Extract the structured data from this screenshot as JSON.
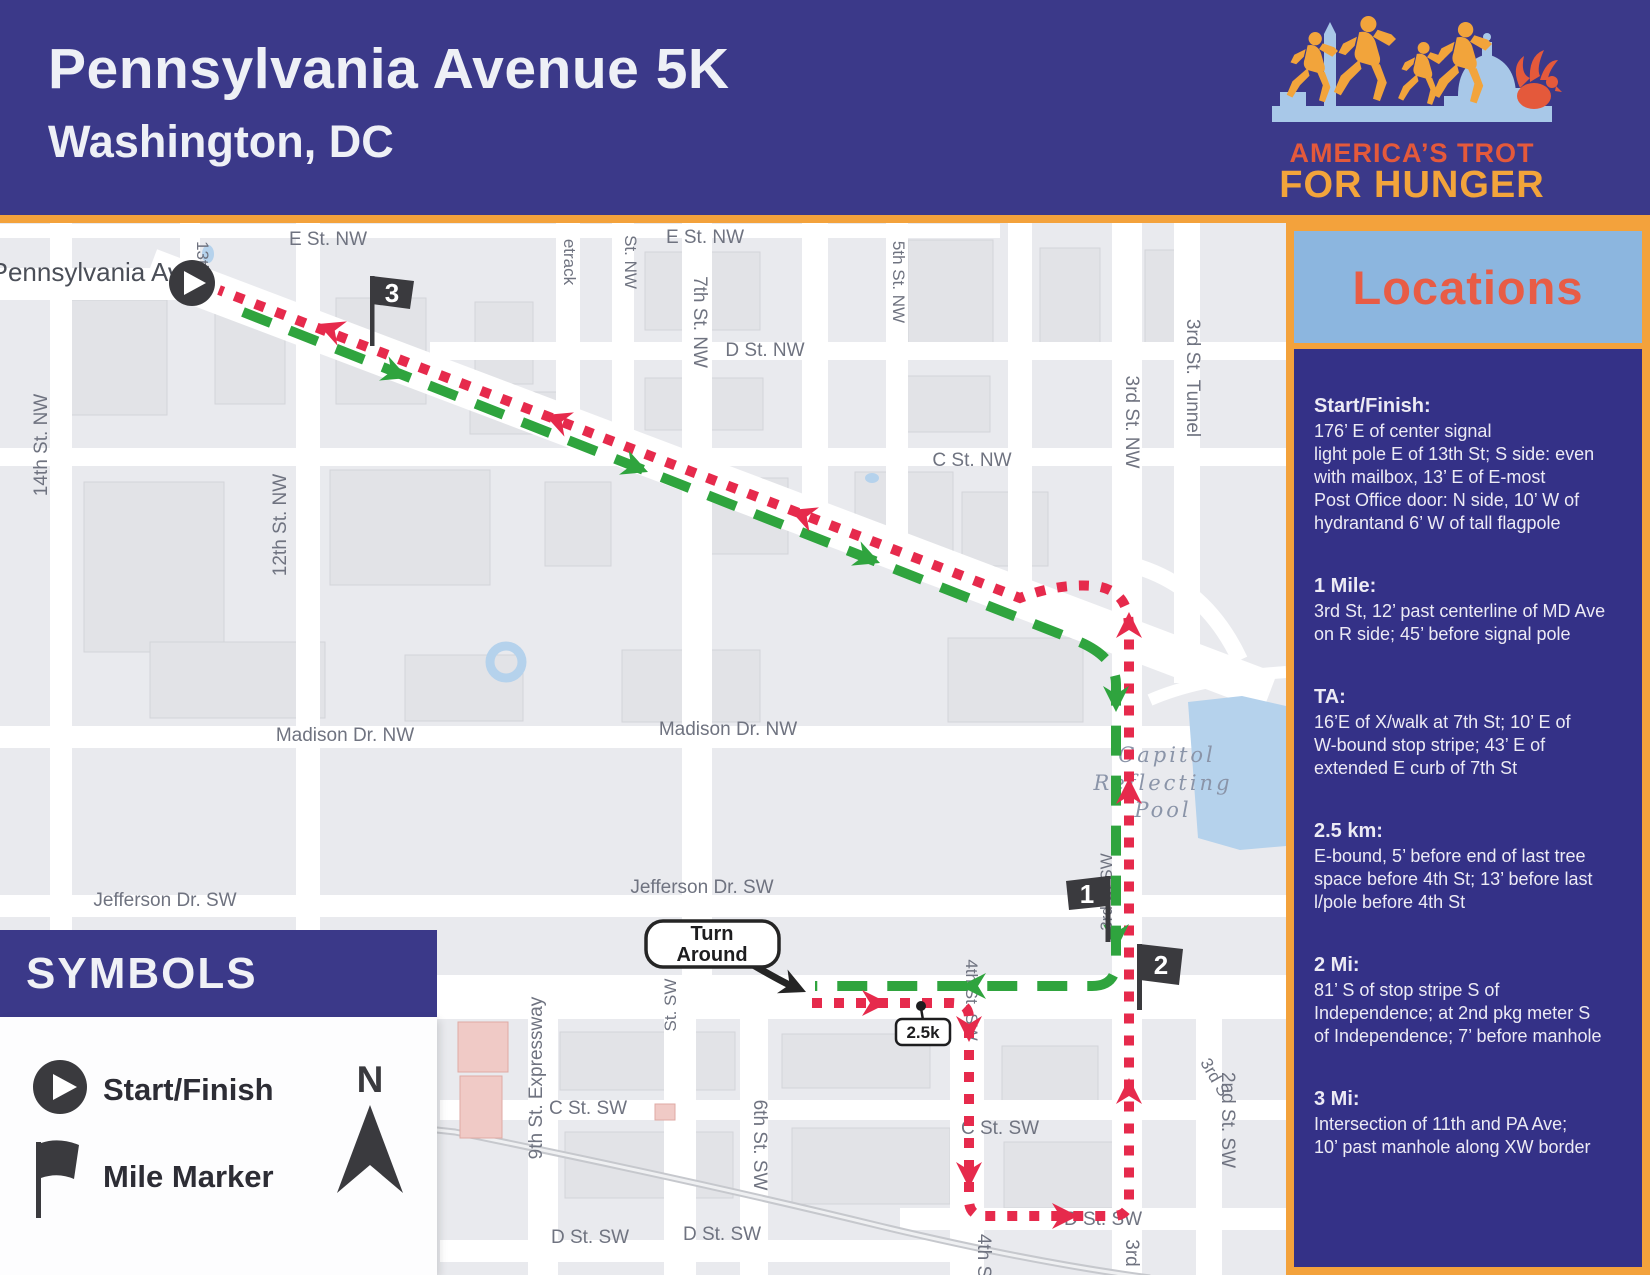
{
  "header": {
    "title": "Pennsylvania Avenue 5K",
    "subtitle": "Washington, DC"
  },
  "logo": {
    "line1": "AMERICA’S TROT",
    "line2": "FOR HUNGER"
  },
  "locations": {
    "title": "Locations",
    "sections": [
      {
        "heading": "Start/Finish:",
        "body": "176’ E of center signal\nlight pole E of 13th St; S side: even\nwith mailbox, 13’ E of E-most\nPost Office door: N side, 10’ W of\nhydrantand 6’ W of tall flagpole"
      },
      {
        "heading": "1 Mile:",
        "body": "3rd St, 12’ past centerline of MD Ave\non R side; 45’ before signal pole"
      },
      {
        "heading": "TA:",
        "body": "16’E of X/walk at 7th St; 10’ E of\nW-bound stop stripe; 43’ E of\nextended E curb of 7th St"
      },
      {
        "heading": "2.5 km:",
        "body": "E-bound, 5’ before end of last tree\nspace before 4th St; 13’ before last\nl/pole before 4th St"
      },
      {
        "heading": "2 Mi:",
        "body": "81’ S of stop stripe S of\nIndependence; at 2nd pkg meter S\nof Independence; 7’ before manhole"
      },
      {
        "heading": "3 Mi:",
        "body": "Intersection of 11th and PA Ave;\n10’ past manhole along XW border"
      }
    ]
  },
  "symbols": {
    "title": "SYMBOLS",
    "items": [
      {
        "label": "Start/Finish"
      },
      {
        "label": "Mile Marker"
      }
    ],
    "compass": "N"
  },
  "map": {
    "mile_markers": {
      "m1": "1",
      "m2": "2",
      "m3": "3"
    },
    "turnaround": {
      "line1": "Turn",
      "line2": "Around"
    },
    "km_marker": "2.5k",
    "street_labels": [
      {
        "t": "Pennsylvania Ave",
        "x": 93,
        "y": 281,
        "s": 26,
        "r": 0,
        "cls": "big"
      },
      {
        "t": "E St. NW",
        "x": 328,
        "y": 245,
        "s": 19,
        "r": 0
      },
      {
        "t": "E St. NW",
        "x": 705,
        "y": 243,
        "s": 19,
        "r": 0
      },
      {
        "t": "D St. NW",
        "x": 765,
        "y": 356,
        "s": 19,
        "r": 0
      },
      {
        "t": "C St. NW",
        "x": 972,
        "y": 466,
        "s": 19,
        "r": 0
      },
      {
        "t": "Madison Dr. NW",
        "x": 345,
        "y": 741,
        "s": 19,
        "r": 0
      },
      {
        "t": "Madison Dr. NW",
        "x": 728,
        "y": 735,
        "s": 19,
        "r": 0
      },
      {
        "t": "Jefferson Dr. SW",
        "x": 165,
        "y": 906,
        "s": 19,
        "r": 0
      },
      {
        "t": "Jefferson Dr. SW",
        "x": 702,
        "y": 893,
        "s": 19,
        "r": 0
      },
      {
        "t": "C St. SW",
        "x": 588,
        "y": 1114,
        "s": 19,
        "r": 0
      },
      {
        "t": "C St. SW",
        "x": 1000,
        "y": 1134,
        "s": 19,
        "r": 0
      },
      {
        "t": "D St. SW",
        "x": 590,
        "y": 1243,
        "s": 19,
        "r": 0
      },
      {
        "t": "D St. SW",
        "x": 722,
        "y": 1240,
        "s": 19,
        "r": 0
      },
      {
        "t": "D St. SW",
        "x": 1103,
        "y": 1225,
        "s": 19,
        "r": 0
      },
      {
        "t": "14th St. NW",
        "x": 47,
        "y": 445,
        "s": 19,
        "r": -90
      },
      {
        "t": "13th St",
        "x": 197,
        "y": 268,
        "s": 17,
        "r": 90
      },
      {
        "t": "12th St. NW",
        "x": 286,
        "y": 525,
        "s": 19,
        "r": -90
      },
      {
        "t": "etrack",
        "x": 564,
        "y": 262,
        "s": 17,
        "r": 90
      },
      {
        "t": "St. NW",
        "x": 625,
        "y": 262,
        "s": 17,
        "r": 90
      },
      {
        "t": "7th St. NW",
        "x": 694,
        "y": 322,
        "s": 19,
        "r": 90
      },
      {
        "t": "5th St. NW",
        "x": 893,
        "y": 282,
        "s": 17,
        "r": 90
      },
      {
        "t": "3rd St. NW",
        "x": 1126,
        "y": 422,
        "s": 19,
        "r": 90
      },
      {
        "t": "3rd St. Tunnel",
        "x": 1187,
        "y": 378,
        "s": 19,
        "r": 90
      },
      {
        "t": "9th St. Expressway",
        "x": 542,
        "y": 1078,
        "s": 19,
        "r": -90
      },
      {
        "t": "St. SW",
        "x": 676,
        "y": 1005,
        "s": 17,
        "r": -90
      },
      {
        "t": "6th St. SW",
        "x": 754,
        "y": 1145,
        "s": 19,
        "r": 90
      },
      {
        "t": "4th St. SW",
        "x": 966,
        "y": 1000,
        "s": 17,
        "r": 90
      },
      {
        "t": "3rd St SW",
        "x": 1112,
        "y": 892,
        "s": 17,
        "r": -90
      },
      {
        "t": "2nd St. SW",
        "x": 1222,
        "y": 1120,
        "s": 19,
        "r": 90
      },
      {
        "t": "3rd",
        "x": 1126,
        "y": 1253,
        "s": 19,
        "r": 90
      },
      {
        "t": "4th S",
        "x": 978,
        "y": 1256,
        "s": 19,
        "r": 90
      },
      {
        "t": "3rd S",
        "x": 1210,
        "y": 1080,
        "s": 17,
        "r": 60
      },
      {
        "t": "Capitol",
        "x": 1167,
        "y": 762,
        "s": 21,
        "r": 0,
        "cls": "pool"
      },
      {
        "t": "Reflecting",
        "x": 1163,
        "y": 790,
        "s": 21,
        "r": 0,
        "cls": "pool"
      },
      {
        "t": "Pool",
        "x": 1163,
        "y": 817,
        "s": 21,
        "r": 0,
        "cls": "pool"
      }
    ]
  },
  "colors": {
    "navy": "#3b3989",
    "navy_panel": "#343187",
    "orange": "#f3a23c",
    "light_blue": "#8cb6df",
    "locations_red": "#e85c45",
    "route_green": "#2fa43e",
    "route_red": "#e62a4c",
    "map_bg": "#e9eaee",
    "pool_blue": "#b5d2ec",
    "marker_dark": "#3a3a3e",
    "logo_orange": "#f2a43b",
    "logo_red": "#e4593b",
    "skyline_blue": "#a8c8e8"
  }
}
